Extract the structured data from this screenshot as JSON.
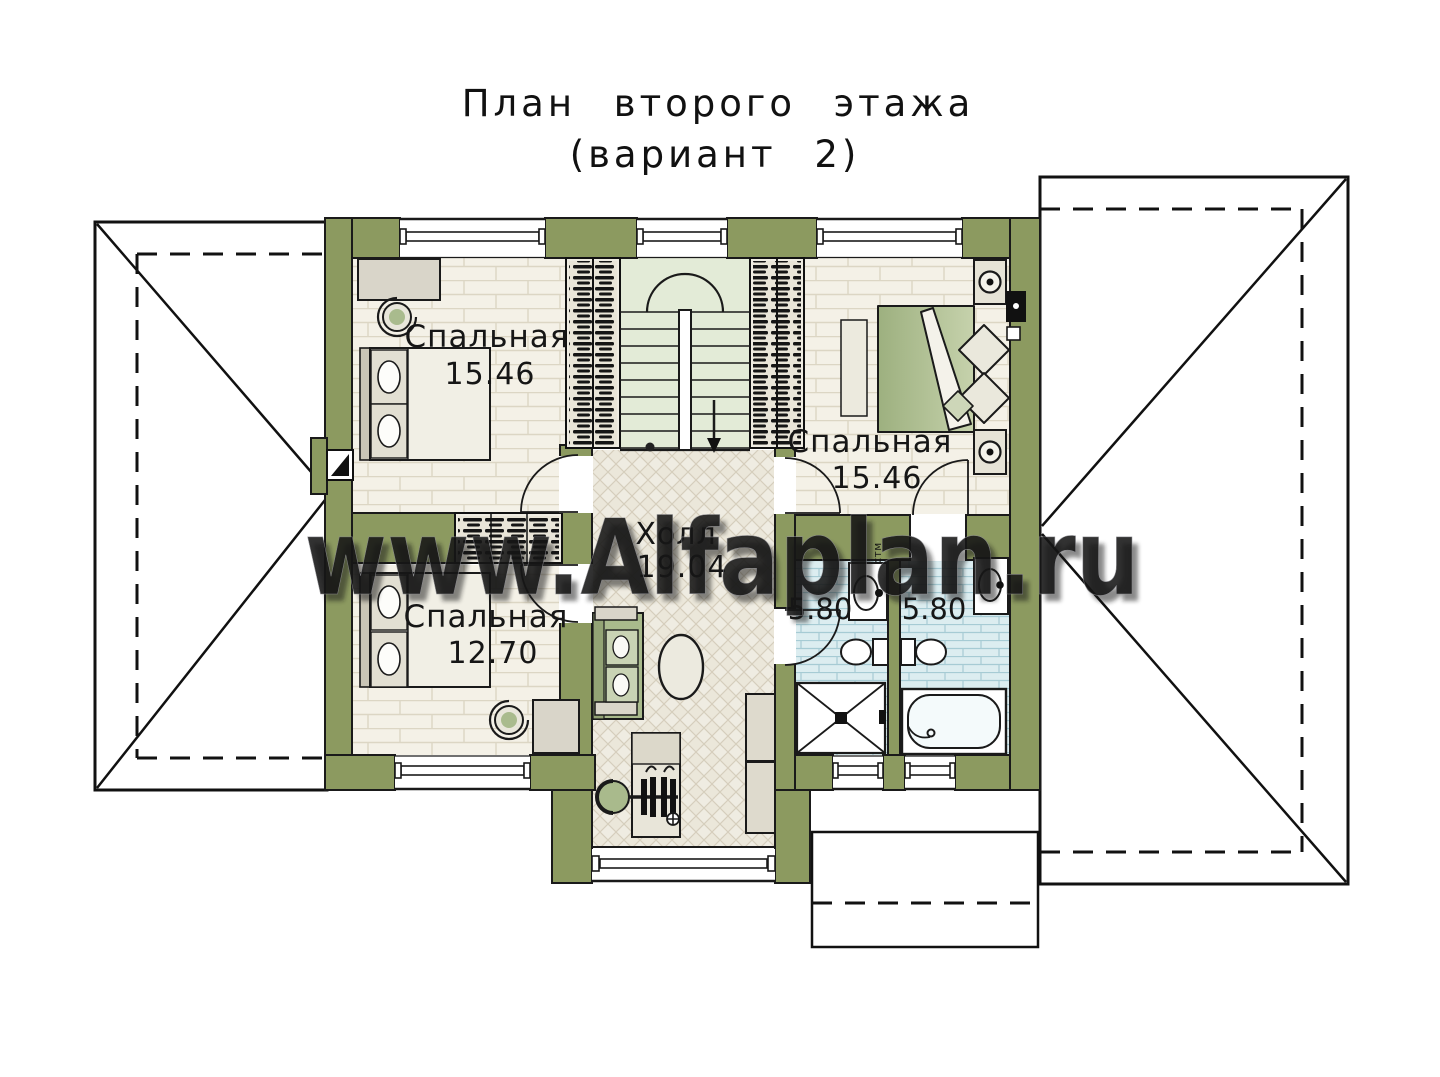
{
  "title": {
    "line1": "План второго этажа",
    "line2": "(вариант 2)"
  },
  "watermark": {
    "text": "www.Alfaplan.ru"
  },
  "rooms": {
    "bedroom_top_left": {
      "name": "Спальная",
      "area": "15.46"
    },
    "bedroom_right": {
      "name": "Спальная",
      "area": "15.46"
    },
    "bedroom_bottom_left": {
      "name": "Спальная",
      "area": "12.70"
    },
    "hall": {
      "name": "Холл",
      "area": "19.04"
    },
    "bathroom_left": {
      "area": "5.80"
    },
    "bathroom_right": {
      "area": "5.80"
    }
  },
  "labels": {
    "washing_machine": "стм"
  },
  "colors": {
    "wall_olive": "#8c9a60",
    "floor_bedroom": "#f4f1e7",
    "floor_hall": "#efece2",
    "floor_stairs": "#e3ebd7",
    "floor_bath": "#dcedf0",
    "furniture_grey": "#d9d5c9",
    "cushion_green": "#a9ba8c",
    "ink": "#1a1a1a",
    "watermark_fill": "#f1f0ea"
  }
}
